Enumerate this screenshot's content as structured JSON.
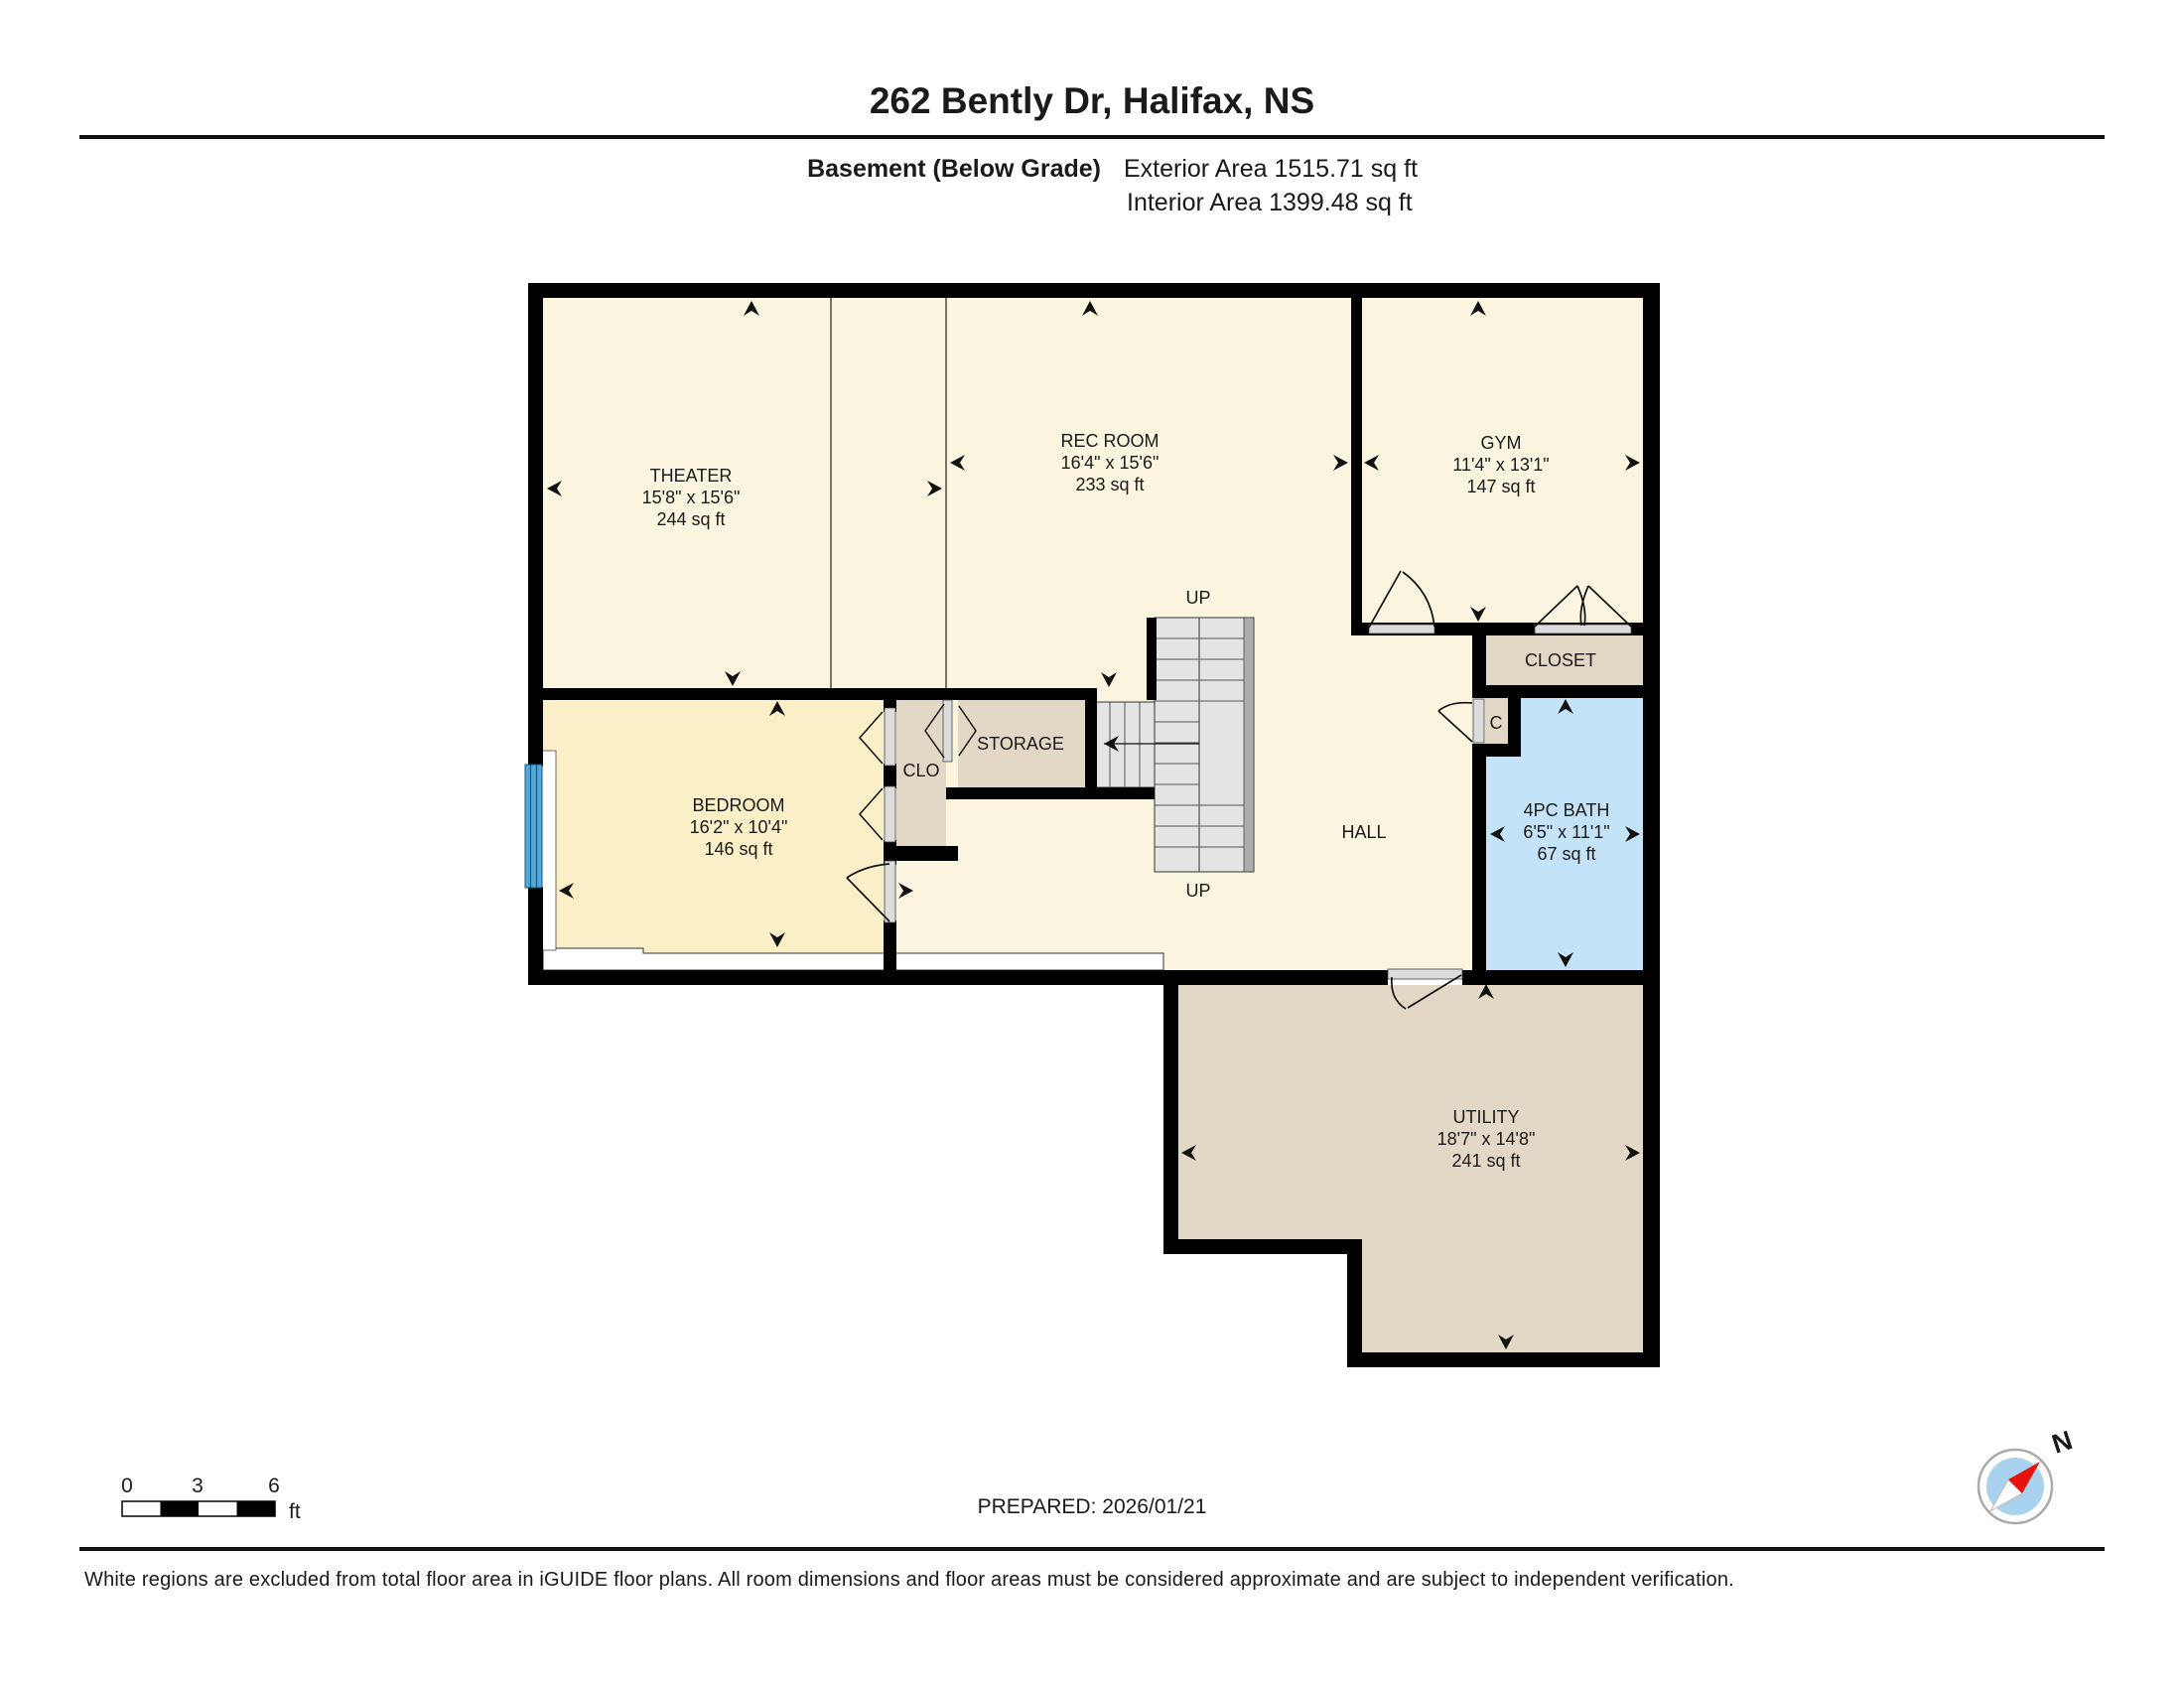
{
  "header": {
    "title": "262 Bently Dr, Halifax, NS",
    "floor_label": "Basement (Below Grade)",
    "exterior_area": "Exterior Area 1515.71 sq ft",
    "interior_area": "Interior Area 1399.48 sq ft"
  },
  "rooms": {
    "theater": {
      "name": "THEATER",
      "dims": "15'8\" x 15'6\"",
      "area": "244 sq ft"
    },
    "rec_room": {
      "name": "REC ROOM",
      "dims": "16'4\" x 15'6\"",
      "area": "233 sq ft"
    },
    "gym": {
      "name": "GYM",
      "dims": "11'4\" x 13'1\"",
      "area": "147 sq ft"
    },
    "bedroom": {
      "name": "BEDROOM",
      "dims": "16'2\" x 10'4\"",
      "area": "146 sq ft"
    },
    "bath": {
      "name": "4PC BATH",
      "dims": "6'5\" x 11'1\"",
      "area": "67 sq ft"
    },
    "utility": {
      "name": "UTILITY",
      "dims": "18'7\" x 14'8\"",
      "area": "241 sq ft"
    },
    "closet_label": "CLOSET",
    "storage_label": "STORAGE",
    "clo_label": "CLO",
    "c_label": "C",
    "hall_label": "HALL",
    "up_label": "UP"
  },
  "scale_bar": {
    "tick_0": "0",
    "tick_3": "3",
    "tick_6": "6",
    "unit": "ft"
  },
  "footer": {
    "prepared": "PREPARED: 2026/01/21",
    "disclaimer": "White regions are excluded from total floor area in iGUIDE floor plans. All room dimensions and floor areas must be considered approximate and are subject to independent verification.",
    "compass_north": "N"
  },
  "colors": {
    "room_cream": "#FBF4DF",
    "room_yellow": "#FAEFC7",
    "room_tan": "#E2D8C5",
    "room_blue": "#C4E3F8",
    "stair_fill": "#E4E4E4",
    "stair_rail": "#ACACAC",
    "window_blue": "#4FA8DC",
    "needle_red": "#E8140C"
  }
}
